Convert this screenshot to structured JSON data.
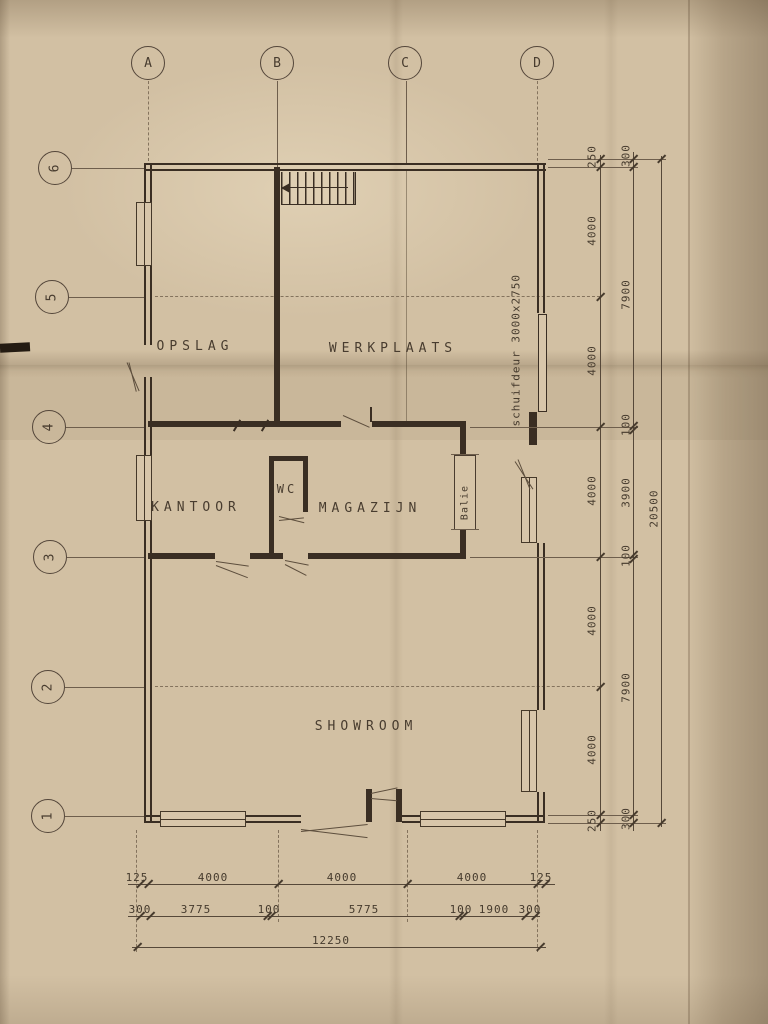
{
  "plan": {
    "grid_cols": [
      "A",
      "B",
      "C",
      "D"
    ],
    "grid_rows": [
      "6",
      "5",
      "4",
      "3",
      "2",
      "1"
    ],
    "rooms": {
      "opslag": "OPSLAG",
      "werkplaats": "WERKPLAATS",
      "kantoor": "KANTOOR",
      "wc": "WC",
      "magazijn": "MAGAZIJN",
      "showroom": "SHOWROOM",
      "balie": "Balie"
    },
    "labels": {
      "schuifdeur": "schuifdeur 3000x2750"
    },
    "dims": {
      "right_inner": [
        "250",
        "4000",
        "4000",
        "4000",
        "4000",
        "4000",
        "250"
      ],
      "right_mid": [
        "300",
        "7900",
        "100",
        "3900",
        "100",
        "7900",
        "300"
      ],
      "right_total": "20500",
      "bottom_a": [
        "125",
        "4000",
        "4000",
        "4000",
        "125"
      ],
      "bottom_b": [
        "300",
        "3775",
        "100",
        "5775",
        "100",
        "1900",
        "300"
      ],
      "bottom_total": "12250"
    },
    "colors": {
      "paper": "#d2c0a3",
      "ink": "#3a2e23",
      "dim_text": "#453a2d"
    }
  }
}
